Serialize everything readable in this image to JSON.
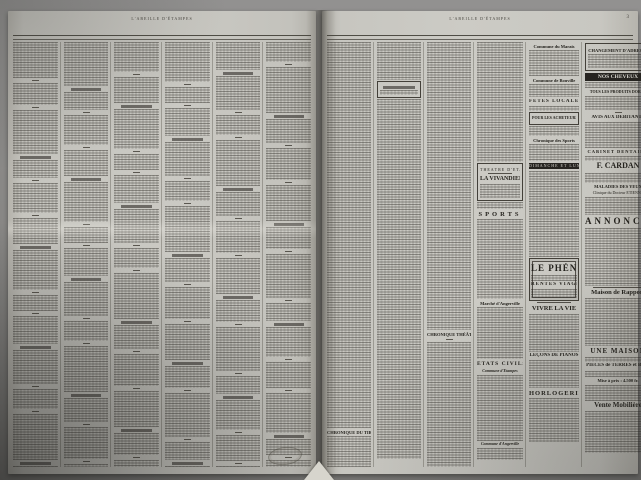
{
  "masthead": {
    "running_title": "L'ABEILLE D'ÉTAMPES",
    "page_number": "3"
  },
  "ink_color": "#24221d",
  "paper_color": "#cac9c3",
  "sections": {
    "chronique_tir": "CHRONIQUE DU TIR",
    "chronique_theatrale": "CHRONIQUE THÉÂTRALE",
    "theatre_venue": "THÉÂTRE D'ÉTAMPES",
    "theatre_show": "LA VIVANDIÈRE",
    "sports": "SPORTS",
    "marche_angerville": "Marché d'Angerville",
    "etats_civils": "ÉTATS CIVILS",
    "commune_etampes": "Commune d'Étampes",
    "commune_angerville": "Commune d'Angerville",
    "commune_marais": "Commune du Marais",
    "commune_bouville": "Commune de Bouville",
    "fetes_locales": "FÊTES LOCALES",
    "pour_les_acheteurs": "POUR LES ACHETEURS",
    "chronique_sports": "Chronique des Sports",
    "dimanche_lundi": "DIMANCHE ET LUNDI"
  },
  "ads": {
    "changement_adresse": "CHANGEMENT D'ADRESSE",
    "nos_cheveux": "NOS CHEVEUX",
    "produits_doret": "TOUS LES PRODUITS DORET",
    "avis_debitants": "AVIS AUX DÉBITANTS",
    "cabinet_dentaire": "CABINET DENTAIRE",
    "cardan": "F. CARDAN",
    "maladies_yeux": "MALADIES DES YEUX",
    "clinique": "Clinique du Docteur ÉTIENNE",
    "annonces": "ANNONCES",
    "phenix": "LE PHÉNIX",
    "rentes_viageres": "RENTES VIAGÈRES",
    "vivre_la_vie": "VIVRE LA VIE",
    "lecons_pianos": "LEÇONS DE PIANOS",
    "horlogerie": "HORLOGERIE",
    "maison_rapport": "Maison de Rapport",
    "une_maison": "UNE MAISON",
    "pieces_terres": "PIÈCES de TERRES et BOIS",
    "mise_a_prix": "Mise à prix : 4.500 fr.",
    "vente_mobiliere": "Vente Mobilière"
  }
}
